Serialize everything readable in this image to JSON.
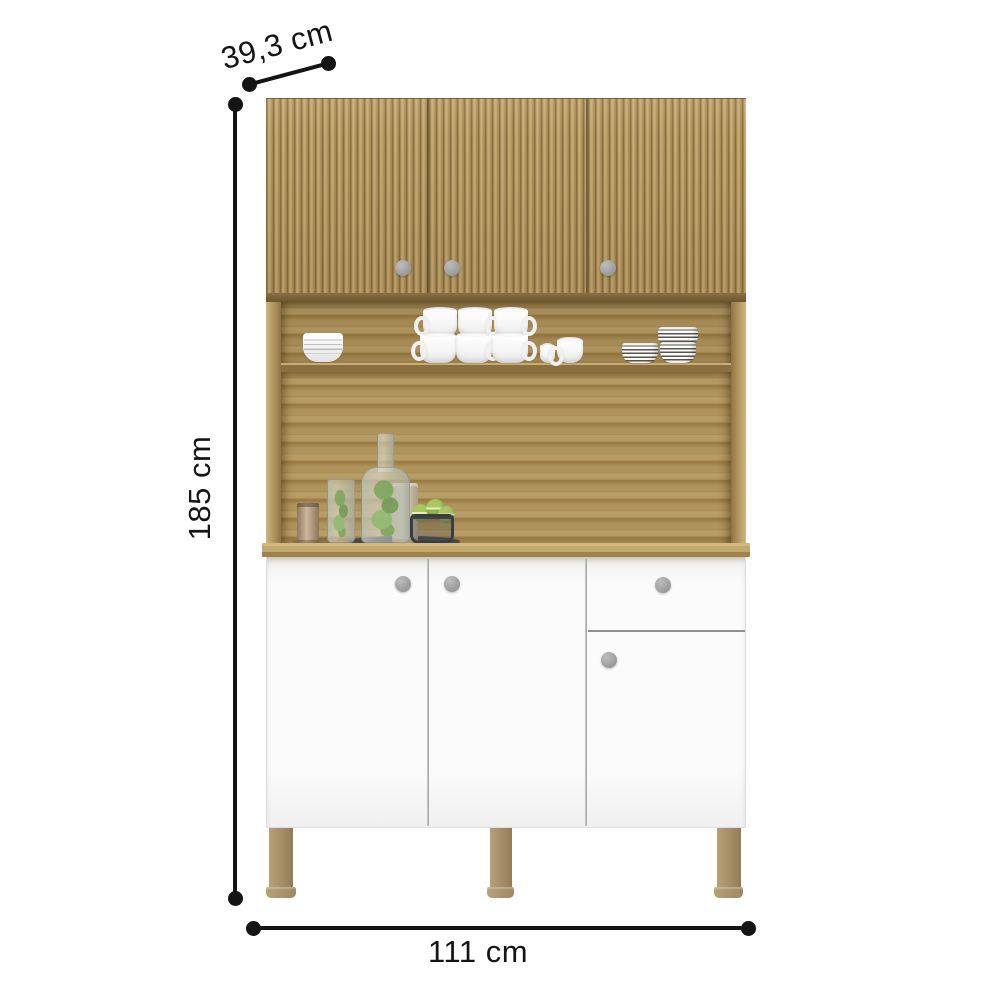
{
  "dims": {
    "depth": "39,3 cm",
    "height": "185 cm",
    "width": "111 cm",
    "unit": "cm",
    "depth_value": 39.3,
    "height_value": 185,
    "width_value": 111
  },
  "product": {
    "upper_doors": 3,
    "lower_doors": 3,
    "drawers": 1,
    "knobs": 7,
    "legs_visible": 3
  },
  "colors": {
    "line": "#141414",
    "flute-dark": "#8a6f41",
    "flute-mid": "#b79b63",
    "flute-light": "#c9ae78",
    "strip-dark": "#6b5530",
    "back-wood": "#b1945c",
    "back-wood-dark": "#97793f",
    "shelf-front": "#8a7040",
    "counter-light": "#d2b87e",
    "counter-dark": "#a0834b",
    "side-light": "#cdb584",
    "side-dark": "#8f7344",
    "cabinet-white": "#fbfbfb",
    "divider": "#9e9e9e",
    "knob": "#9a9a9a",
    "leg": "#a8906a",
    "plant": "#7aa65c",
    "macaron": "#a9c75e",
    "tray": "#45474c",
    "basket": "#383d44",
    "bronze": "#cbb69c"
  }
}
